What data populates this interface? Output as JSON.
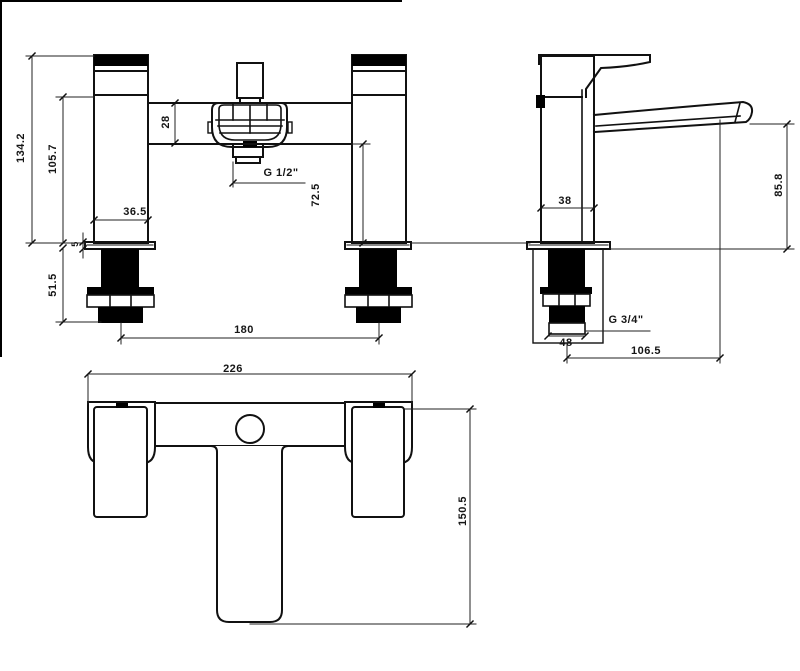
{
  "drawing": {
    "type": "bath-shower-mixer-tap-technical-drawing",
    "views": {
      "front": "front elevation",
      "side": "side elevation",
      "plan": "plan view"
    },
    "colors": {
      "line": "#111111",
      "dim_line": "#222222",
      "background": "#ffffff"
    }
  },
  "labels": {
    "front_overall_height": "134.2",
    "front_height_to_body": "105.7",
    "front_thread_length": "51.5",
    "front_plate_thickness": "5",
    "front_pillar_width": "36.5",
    "front_body_bar_height": "28",
    "front_shower_outlet_thread": "G 1/2\"",
    "front_body_to_deck": "72.5",
    "front_tap_centres": "180",
    "side_body_width": "38",
    "side_spout_height": "85.8",
    "side_inlet_thread": "G 3/4\"",
    "side_base_width": "48",
    "side_spout_reach": "106.5",
    "plan_overall_width": "226",
    "plan_overall_depth": "150.5"
  }
}
